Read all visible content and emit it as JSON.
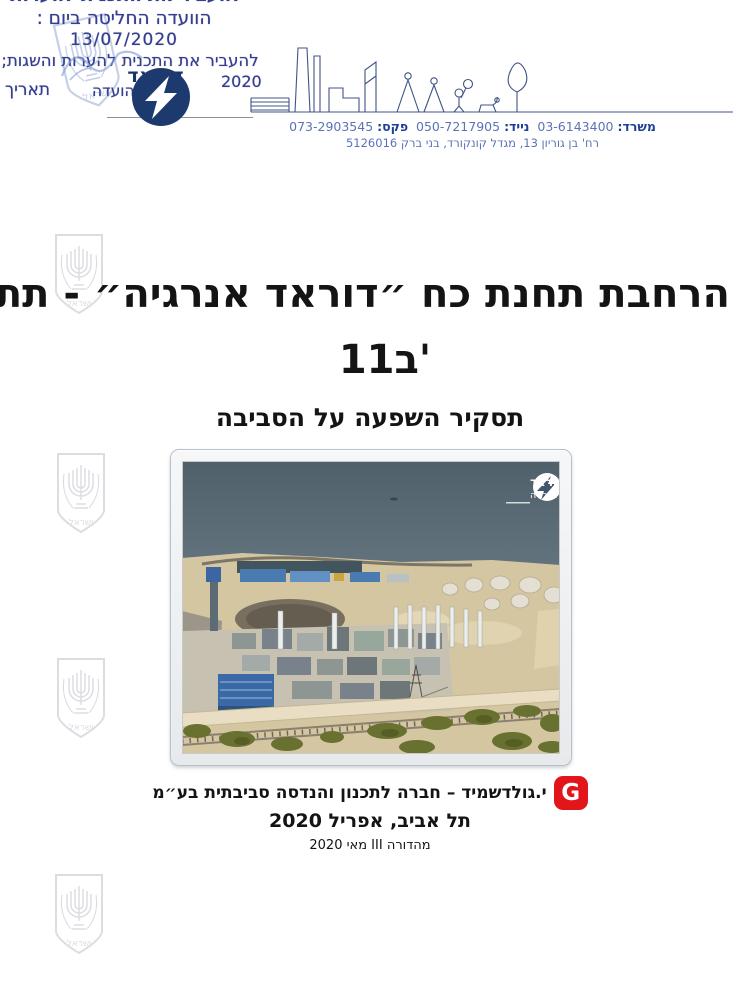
{
  "stamp": {
    "line1": "הוועדה החליטה ביום :",
    "date": "13/07/2020",
    "line2": "להעביר את התכנית להערות והשגות;",
    "year": "2020",
    "date_label": "תאריך",
    "secretary_label": "מזכירות הועדה"
  },
  "dorad_logo": {
    "name": "דוראד",
    "tagline": "אנרגיה"
  },
  "contact": {
    "office_label": "משרד:",
    "office_number": "03-6143400",
    "mobile_label": "נייד:",
    "mobile_number": "050-7217905",
    "fax_label": "פקס:",
    "fax_number": "073-2903545",
    "address": "רח' בן גוריון 13, מגדל קונקורד, בני ברק 5126016"
  },
  "title": {
    "line1": "הרחבת תחנת כח ״דוראד אנרגיה״ - תת״ל",
    "line2": "11ב'",
    "subtitle": "תסקיר השפעה על הסביבה"
  },
  "photo_overlay": {
    "logo_name": "דוראד",
    "logo_tagline": "אנרגיה"
  },
  "footer": {
    "company": "י.גולדשמיד – חברה לתכנון והנדסה סביבתית בע״מ",
    "city_date": "תל אביב, אפריל 2020",
    "edition": "מהדורה III מאי 2020",
    "logo_letter": "G"
  },
  "watermark": {
    "label": "ישראל"
  },
  "colors": {
    "stamp_blue": "#343d8f",
    "dorad_navy": "#15356b",
    "contact_blue": "#5b74b8",
    "accent_red": "#e2151b"
  }
}
